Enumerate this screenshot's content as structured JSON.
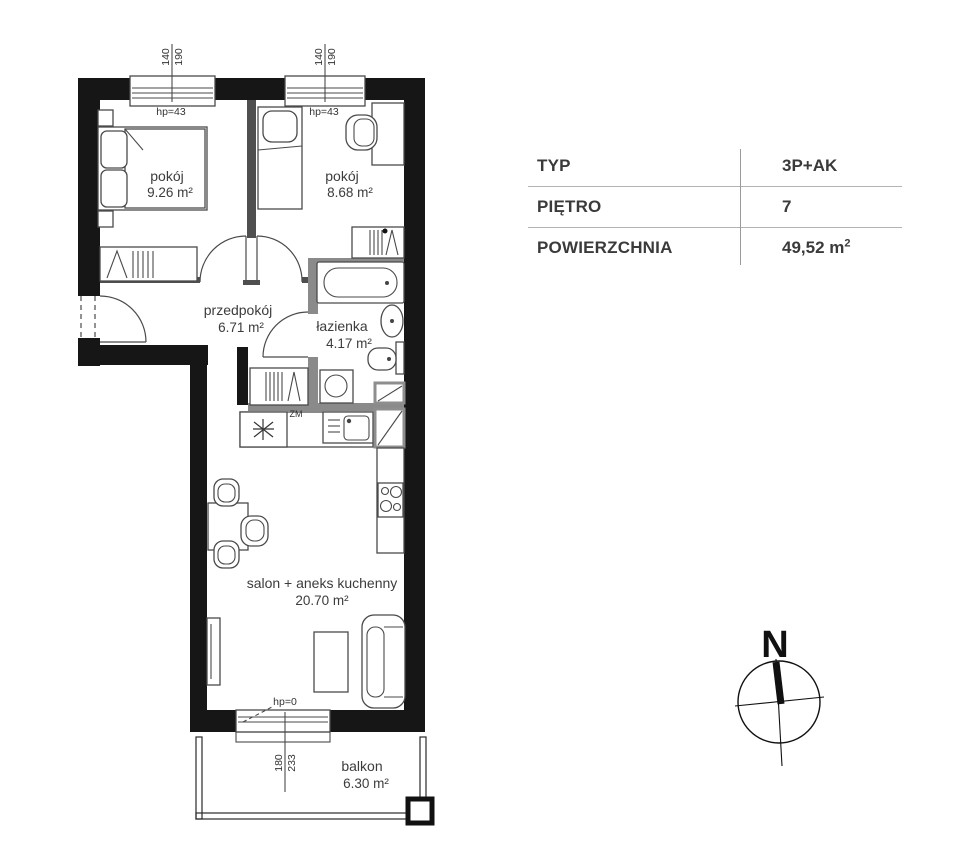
{
  "rooms": {
    "room1": {
      "label": "pokój",
      "area": "9.26 m²"
    },
    "room2": {
      "label": "pokój",
      "area": "8.68 m²"
    },
    "hall": {
      "label": "przedpokój",
      "area": "6.71 m²"
    },
    "bath": {
      "label": "łazienka",
      "area": "4.17 m²"
    },
    "salon": {
      "label": "salon + aneks kuchenny",
      "area": "20.70 m²"
    },
    "balcony": {
      "label": "balkon",
      "area": "6.30 m²"
    }
  },
  "dimensions": {
    "window1": {
      "width": "140",
      "height": "190",
      "hp": "hp=43"
    },
    "window2": {
      "width": "140",
      "height": "190",
      "hp": "hp=43"
    },
    "balcony_door": {
      "width": "180",
      "height": "233",
      "hp": "hp=0"
    }
  },
  "labels": {
    "kitchen_unit": "ZM"
  },
  "info_table": {
    "rows": [
      {
        "label": "TYP",
        "value": "3P+AK",
        "value_sup": ""
      },
      {
        "label": "PIĘTRO",
        "value": "7",
        "value_sup": ""
      },
      {
        "label": "POWIERZCHNIA",
        "value": "49,52 m",
        "value_sup": "2"
      }
    ]
  },
  "compass": {
    "north": "N"
  }
}
